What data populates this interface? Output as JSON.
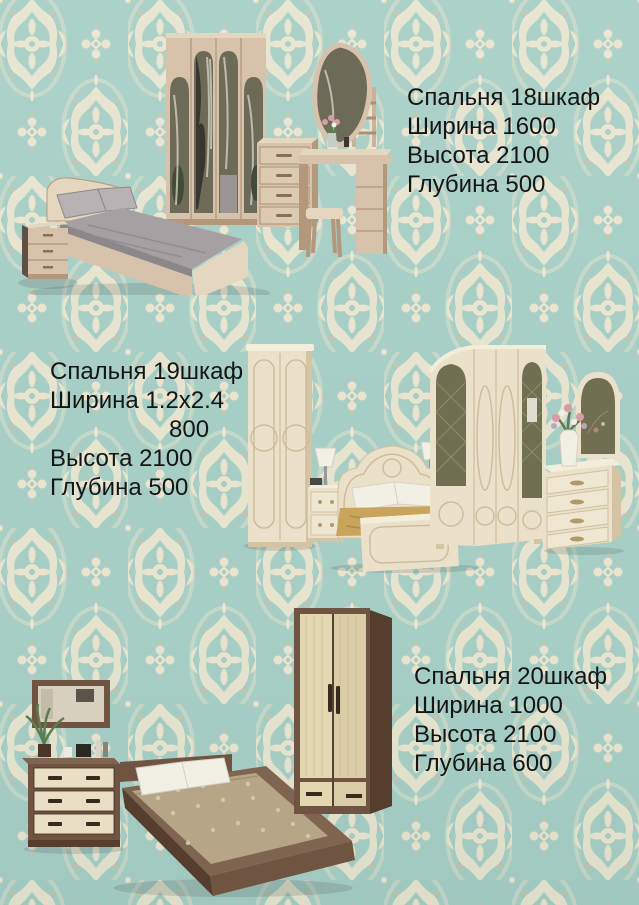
{
  "colors": {
    "wallpaper-teal": "#a6cec5",
    "wallpaper-cream": "#eae4cf",
    "wallpaper-shadow": "#c9c2ae",
    "text": "#151515",
    "ash-wood": "#d7c3ab",
    "ash-wood-dark": "#b3987c",
    "mirror-olive": "#6e6a58",
    "gray-bedding": "#a7a0a2",
    "cream-furniture": "#ebe1cb",
    "cream-shade": "#d4c4a4",
    "gold-bedspread": "#c8a45c",
    "walnut": "#6f5442",
    "walnut-dark": "#563e2e",
    "beige-bedspread": "#b6a687"
  },
  "products": [
    {
      "title": "Спальня 18шкаф",
      "width": "Ширина 1600",
      "height": "Высота 2100",
      "depth": "Глубина 500"
    },
    {
      "title": "Спальня 19шкаф",
      "width": "Ширина 1.2х2.4",
      "width_extra": "800",
      "height": "Высота 2100",
      "depth": "Глубина 500"
    },
    {
      "title": "Спальня 20шкаф",
      "width": "Ширина 1000",
      "height": "Высота 2100",
      "depth": "Глубина 600"
    }
  ]
}
